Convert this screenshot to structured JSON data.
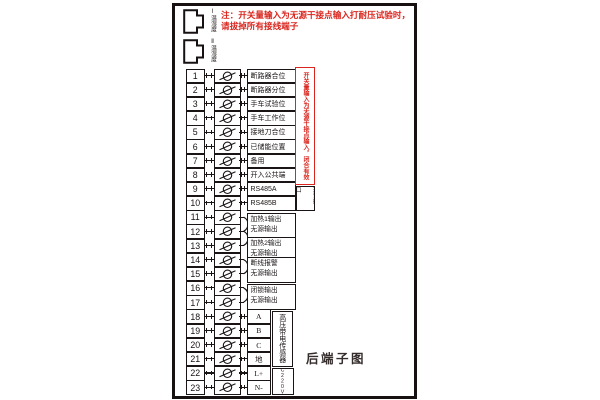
{
  "title_note": {
    "line1": "注：开关量输入为无源干接点输入打耐压试验时，",
    "line2": "请拔掉所有接线端子"
  },
  "connectors": [
    {
      "label": "Ⅰ温湿度"
    },
    {
      "label": "Ⅱ温湿度"
    }
  ],
  "terminal_rows": [
    {
      "num": "1",
      "label": "断路器合位",
      "w": "wide"
    },
    {
      "num": "2",
      "label": "断路器分位",
      "w": "wide"
    },
    {
      "num": "3",
      "label": "手车试验位",
      "w": "wide"
    },
    {
      "num": "4",
      "label": "手车工作位",
      "w": "wide"
    },
    {
      "num": "5",
      "label": "接地刀合位",
      "w": "wide"
    },
    {
      "num": "6",
      "label": "已储能位置",
      "w": "wide"
    },
    {
      "num": "7",
      "label": "备用",
      "w": "wide"
    },
    {
      "num": "8",
      "label": "开入公共端",
      "w": "wide"
    },
    {
      "num": "9",
      "label": "RS485A",
      "w": "wide"
    },
    {
      "num": "10",
      "label": "RS485B",
      "w": "wide"
    },
    {
      "num": "11"
    },
    {
      "num": "12"
    },
    {
      "num": "13"
    },
    {
      "num": "14"
    },
    {
      "num": "15"
    },
    {
      "num": "16"
    },
    {
      "num": "17"
    },
    {
      "num": "18",
      "label": "A",
      "w": "narrow"
    },
    {
      "num": "19",
      "label": "B",
      "w": "narrow"
    },
    {
      "num": "20",
      "label": "C",
      "w": "narrow"
    },
    {
      "num": "21",
      "label": "地",
      "w": "narrow"
    },
    {
      "num": "22",
      "label": "L+",
      "w": "narrow"
    },
    {
      "num": "23",
      "label": "N-",
      "w": "narrow"
    }
  ],
  "output_groups": [
    {
      "pair": [
        11,
        12
      ],
      "line1": "加热1输出",
      "line2": "无源输出",
      "top": 212.5,
      "h": 22.5
    },
    {
      "pair": [
        12,
        13
      ],
      "line1": "加热2输出",
      "line2": "无源输出",
      "top": 236.5,
      "h": 22.5
    },
    {
      "pair": [
        14,
        15
      ],
      "line1": "断线报警",
      "line2": "无源输出",
      "top": 257,
      "h": 23
    },
    {
      "pair": [
        16,
        17
      ],
      "line1": "闭锁输出",
      "line2": "无源输出",
      "top": 284,
      "h": 23
    }
  ],
  "side_annotations": {
    "switch_input_note": "开关量输入为无源干接点输入，闭合有效",
    "comm_port": "通讯接口",
    "hv_sensor": "高压带电传感器",
    "device_power": "装置电源",
    "power_rating": "AC220V"
  },
  "caption": "后端子图",
  "colors": {
    "line": "#1a1414",
    "red": "#d9251d"
  }
}
